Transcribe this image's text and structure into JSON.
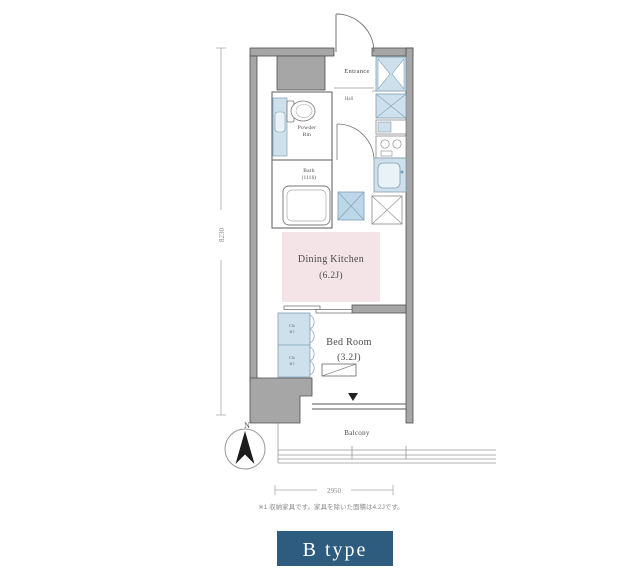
{
  "plan": {
    "labels": {
      "entrance": "Entrance",
      "hall": "Hall",
      "powder_1": "Powder",
      "powder_2": "Rm",
      "bath": "Bath",
      "bath_size": "(1116)",
      "dk": "Dining Kitchen",
      "dk_size": "(6.2J)",
      "bedroom": "Bed Room",
      "bedroom_size": "(3.2J)",
      "balcony": "Balcony",
      "closet": "Clo",
      "closet_ref": "※1"
    },
    "dims": {
      "vertical": "8230",
      "horizontal": "2950"
    },
    "compass_label": "N"
  },
  "footnote": "※1 収納家具です。家具を除いた面積は4.2Jです。",
  "type_badge": "B type",
  "colors": {
    "badge_bg": "#2d5c7f",
    "fixture_blue": "#cde0ec",
    "washer_blue": "#bcd8e8",
    "dk_pink": "#f4e4e7",
    "wall_gray": "#a6a6a6"
  }
}
